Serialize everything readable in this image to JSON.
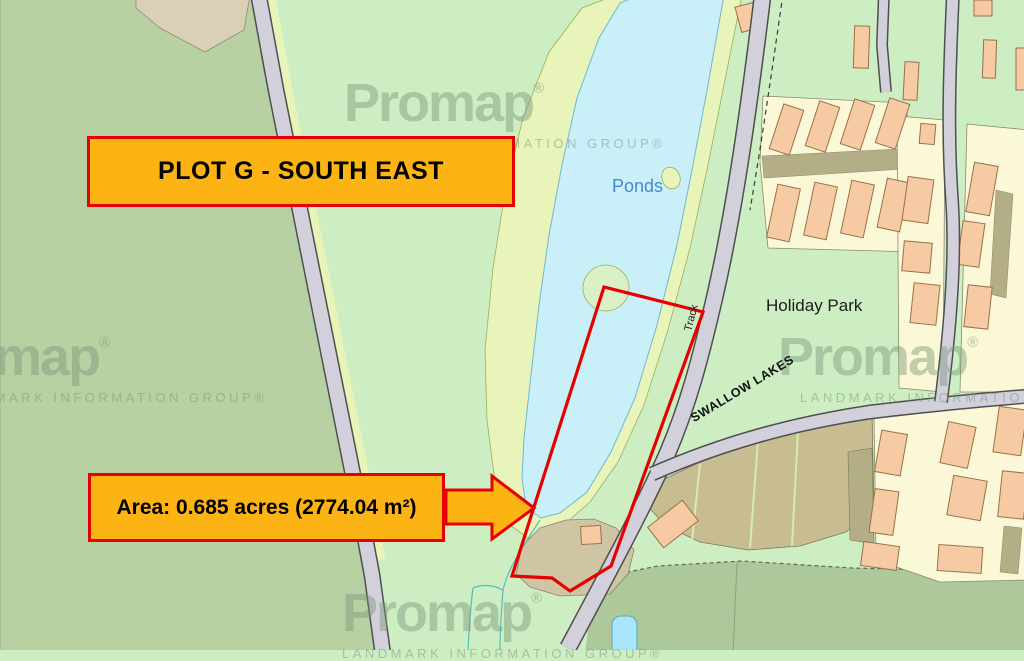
{
  "annotations": {
    "title": "PLOT G - SOUTH EAST",
    "area": "Area: 0.685 acres (2774.04 m²)"
  },
  "map": {
    "labels": {
      "ponds": "Ponds",
      "holiday_park": "Holiday Park",
      "track": "Track",
      "swallow_lakes": "SWALLOW LAKES"
    }
  },
  "watermark": {
    "brand": "Promap",
    "reg": "®",
    "tagline": "LANDMARK INFORMATION GROUP®"
  },
  "colors": {
    "callout_fill": "#fcb415",
    "callout_border": "#e60000",
    "plot_outline": "#e60000",
    "pond": "#c9eff9",
    "field_sage": "#b7d1a2",
    "field_mint": "#cdeec3",
    "verge_lime": "#e9f4ba",
    "road_gray": "#d2d0da",
    "building_peach": "#f6caa2",
    "plot_yellow": "#faf8d6",
    "tan": "#cfc5a4",
    "ponds_label_blue": "#4a87cf"
  }
}
